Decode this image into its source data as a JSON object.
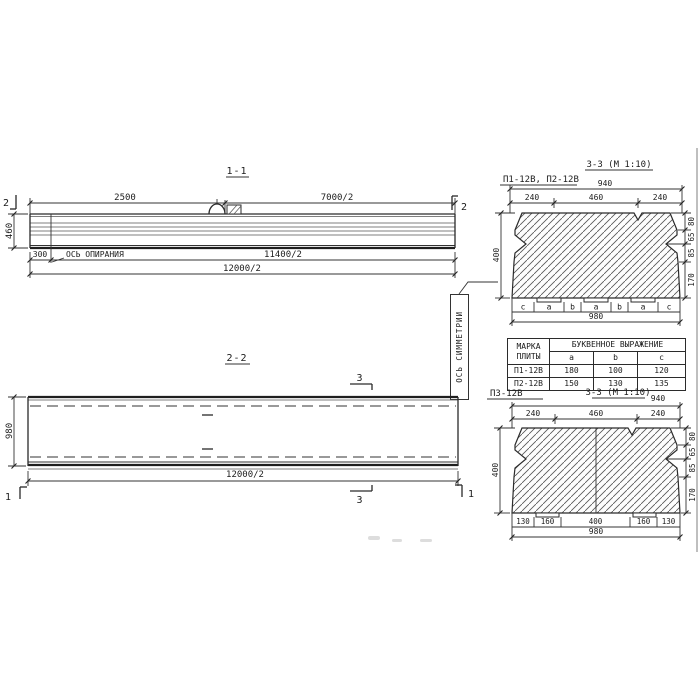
{
  "s11": {
    "title": "1-1",
    "d2500": "2500",
    "d7000": "7000/2",
    "h": "460",
    "d300": "300",
    "d11400": "11400/2",
    "d12000": "12000/2",
    "axis_label": "ОСЬ ОПИРАНИЯ",
    "marker": "2"
  },
  "s22": {
    "title": "2-2",
    "w": "980",
    "d12000": "12000/2",
    "marker3": "3",
    "marker1": "1"
  },
  "sym_label": "ОСЬ СИММЕТРИИ",
  "s33t": {
    "label": "П1-12В, П2-12В",
    "title": "3-3 (М 1:10)",
    "d940": "940",
    "d240": "240",
    "d460": "460",
    "d400": "400",
    "d80": "80",
    "d65": "65",
    "d85": "85",
    "d170": "170",
    "d980": "980",
    "letters": [
      "c",
      "a",
      "b",
      "a",
      "b",
      "a",
      "c"
    ]
  },
  "table": {
    "c1": "МАРКА ПЛИТЫ",
    "c2": "БУКВЕННОЕ ВЫРАЖЕНИЕ",
    "sub": [
      "a",
      "b",
      "c"
    ],
    "rows": [
      [
        "П1-12В",
        "180",
        "100",
        "120"
      ],
      [
        "П2-12В",
        "150",
        "130",
        "135"
      ]
    ]
  },
  "s33b": {
    "label": "П3-12В",
    "title": "3-3 (М 1:10)",
    "d940": "940",
    "d240": "240",
    "d460": "460",
    "d400": "400",
    "d80": "80",
    "d65": "65",
    "d85": "85",
    "d170": "170",
    "d980": "980",
    "b130": "130",
    "b160": "160",
    "b400": "400"
  }
}
